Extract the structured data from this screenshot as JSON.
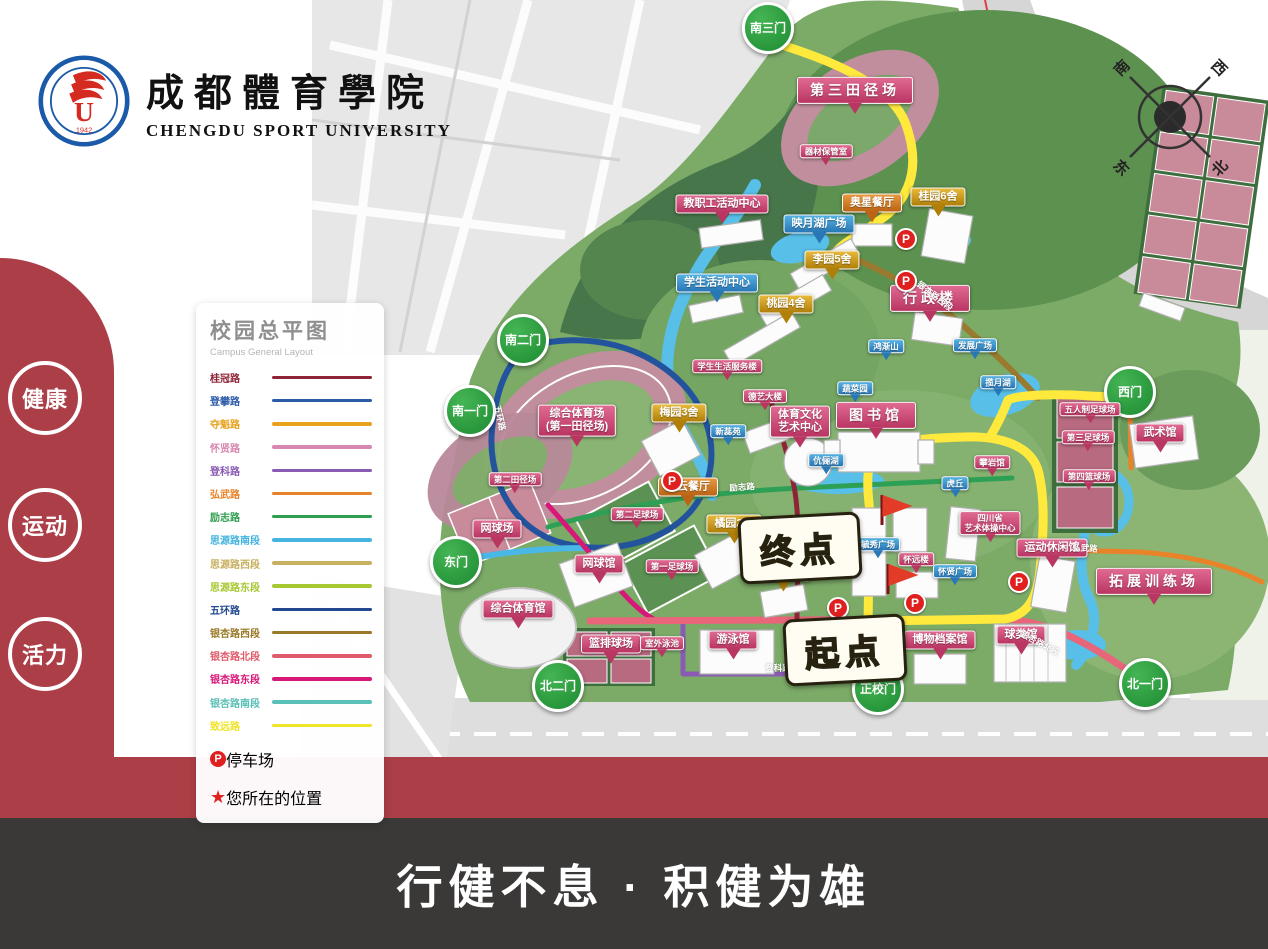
{
  "header": {
    "title_zh": "成都體育學院",
    "title_en": "CHENGDU SPORT UNIVERSITY",
    "logo_year": "1942",
    "logo_letter": "U"
  },
  "side_badges": [
    {
      "label": "健康"
    },
    {
      "label": "运动"
    },
    {
      "label": "活力"
    }
  ],
  "footer": {
    "slogan": "行健不息 · 积健为雄"
  },
  "compass": {
    "south": "南",
    "west": "西",
    "east": "东",
    "north": "北"
  },
  "legend": {
    "title": "校园总平图",
    "subtitle": "Campus General Layout",
    "roads": [
      {
        "name": "桂冠路",
        "color": "#8f2438"
      },
      {
        "name": "登攀路",
        "color": "#2b5ba8"
      },
      {
        "name": "夺魁路",
        "color": "#e8a21e"
      },
      {
        "name": "怀贤路",
        "color": "#d888b0"
      },
      {
        "name": "登科路",
        "color": "#8a5bb5"
      },
      {
        "name": "弘武路",
        "color": "#e8832a"
      },
      {
        "name": "励志路",
        "color": "#2e9e50"
      },
      {
        "name": "思源路南段",
        "color": "#45b4e0"
      },
      {
        "name": "思源路西段",
        "color": "#c8b060"
      },
      {
        "name": "思源路东段",
        "color": "#a8c832"
      },
      {
        "name": "五环路",
        "color": "#22488f"
      },
      {
        "name": "银杏路西段",
        "color": "#9a7a28"
      },
      {
        "name": "银杏路北段",
        "color": "#e05a6a"
      },
      {
        "name": "银杏路东段",
        "color": "#d81878"
      },
      {
        "name": "银杏路南段",
        "color": "#5bc0b8"
      },
      {
        "name": "致远路",
        "color": "#f0e428"
      }
    ],
    "symbols": [
      {
        "icon": "parking-icon",
        "label": "停车场"
      },
      {
        "icon": "star-icon",
        "label": "您所在的位置"
      }
    ]
  },
  "map": {
    "gates": [
      {
        "text": "南三门",
        "x": 768,
        "y": 28
      },
      {
        "text": "南二门",
        "x": 523,
        "y": 340
      },
      {
        "text": "南一门",
        "x": 470,
        "y": 411
      },
      {
        "text": "西门",
        "x": 1130,
        "y": 392
      },
      {
        "text": "东门",
        "x": 456,
        "y": 562
      },
      {
        "text": "北二门",
        "x": 558,
        "y": 686
      },
      {
        "text": "正校门",
        "x": 878,
        "y": 689
      },
      {
        "text": "北一门",
        "x": 1145,
        "y": 684
      }
    ],
    "labels": [
      {
        "type": "building",
        "text": "第三田径场",
        "x": 855,
        "y": 99,
        "big": true
      },
      {
        "type": "building",
        "text": "器材保管室",
        "x": 826,
        "y": 157,
        "small": true
      },
      {
        "type": "building",
        "text": "教职工活动中心",
        "x": 722,
        "y": 212
      },
      {
        "type": "site",
        "text": "映月湖广场",
        "x": 819,
        "y": 232
      },
      {
        "type": "rest",
        "text": "奥星餐厅",
        "x": 872,
        "y": 211
      },
      {
        "type": "dorm",
        "text": "桂园6舍",
        "x": 938,
        "y": 205
      },
      {
        "type": "dorm",
        "text": "李园5舍",
        "x": 832,
        "y": 268
      },
      {
        "type": "site",
        "text": "学生活动中心",
        "x": 717,
        "y": 291
      },
      {
        "type": "dorm",
        "text": "桃园4舍",
        "x": 786,
        "y": 312
      },
      {
        "type": "building",
        "text": "行政楼",
        "x": 930,
        "y": 307,
        "big": true
      },
      {
        "type": "site",
        "text": "鸿渐山",
        "x": 886,
        "y": 352,
        "small": true
      },
      {
        "type": "site",
        "text": "发展广场",
        "x": 975,
        "y": 351,
        "small": true
      },
      {
        "type": "site",
        "text": "揽月湖",
        "x": 998,
        "y": 388,
        "small": true
      },
      {
        "type": "building",
        "text": "学生生活服务楼",
        "x": 727,
        "y": 372,
        "small": true
      },
      {
        "type": "building",
        "text": "德艺大楼",
        "x": 765,
        "y": 402,
        "small": true
      },
      {
        "type": "site",
        "text": "蔬菜园",
        "x": 855,
        "y": 394,
        "small": true
      },
      {
        "type": "dorm",
        "text": "梅园3舍",
        "x": 679,
        "y": 421
      },
      {
        "type": "site",
        "text": "新蕊苑",
        "x": 728,
        "y": 437,
        "small": true
      },
      {
        "type": "building",
        "text": "体育文化",
        "text2": "艺术中心",
        "x": 800,
        "y": 431
      },
      {
        "type": "building",
        "text": "图书馆",
        "x": 876,
        "y": 424,
        "big": true
      },
      {
        "type": "site",
        "text": "伉俪湖",
        "x": 826,
        "y": 466,
        "small": true
      },
      {
        "type": "building",
        "text": "攀岩馆",
        "x": 992,
        "y": 468,
        "small": true
      },
      {
        "type": "site",
        "text": "虎丘",
        "x": 955,
        "y": 489,
        "small": true
      },
      {
        "type": "building",
        "text": "武术馆",
        "x": 1160,
        "y": 441
      },
      {
        "type": "building",
        "text": "五人制足球场",
        "x": 1090,
        "y": 415,
        "small": true
      },
      {
        "type": "building",
        "text": "第三足球场",
        "x": 1088,
        "y": 443,
        "small": true
      },
      {
        "type": "building",
        "text": "第四篮球场",
        "x": 1089,
        "y": 482,
        "small": true
      },
      {
        "type": "building",
        "text": "综合体育场",
        "text2": "(第一田径场)",
        "x": 577,
        "y": 430
      },
      {
        "type": "building",
        "text": "第二田径场",
        "x": 515,
        "y": 485,
        "small": true
      },
      {
        "type": "rest",
        "text": "冠云餐厅",
        "x": 688,
        "y": 495
      },
      {
        "type": "building",
        "text": "第二足球场",
        "x": 637,
        "y": 520,
        "small": true
      },
      {
        "type": "building",
        "text": "网球场",
        "x": 497,
        "y": 537
      },
      {
        "type": "building",
        "text": "第一足球场",
        "x": 672,
        "y": 572,
        "small": true
      },
      {
        "type": "building",
        "text": "网球馆",
        "x": 599,
        "y": 572
      },
      {
        "type": "dorm",
        "text": "橘园2舍",
        "x": 734,
        "y": 532
      },
      {
        "type": "dorm",
        "text": "香园1舍",
        "x": 783,
        "y": 580
      },
      {
        "type": "site",
        "text": "毓秀广场",
        "x": 878,
        "y": 550,
        "small": true
      },
      {
        "type": "building",
        "text": "怀远楼",
        "x": 916,
        "y": 565,
        "small": true
      },
      {
        "type": "site",
        "text": "怀贤广场",
        "x": 955,
        "y": 577,
        "small": true
      },
      {
        "type": "building",
        "text": "四川省",
        "text2": "艺术体操中心",
        "x": 990,
        "y": 530,
        "small": true
      },
      {
        "type": "building",
        "text": "运动休闲馆",
        "x": 1052,
        "y": 556
      },
      {
        "type": "building",
        "text": "拓展训练场",
        "x": 1154,
        "y": 590,
        "big": true
      },
      {
        "type": "building",
        "text": "综合体育馆",
        "x": 518,
        "y": 617
      },
      {
        "type": "building",
        "text": "篮排球场",
        "x": 611,
        "y": 652
      },
      {
        "type": "building",
        "text": "室外泳池",
        "x": 662,
        "y": 649,
        "small": true
      },
      {
        "type": "building",
        "text": "游泳馆",
        "x": 733,
        "y": 648
      },
      {
        "type": "building",
        "text": "博物档案馆",
        "x": 940,
        "y": 648
      },
      {
        "type": "building",
        "text": "球类馆",
        "x": 1021,
        "y": 643
      }
    ],
    "route_points": [
      {
        "text": "终点",
        "x": 800,
        "y": 548
      },
      {
        "text": "起点",
        "x": 845,
        "y": 650
      }
    ],
    "parkings": [
      {
        "x": 906,
        "y": 239
      },
      {
        "x": 906,
        "y": 281
      },
      {
        "x": 672,
        "y": 481
      },
      {
        "x": 838,
        "y": 608
      },
      {
        "x": 915,
        "y": 603
      },
      {
        "x": 1019,
        "y": 582
      }
    ],
    "flags": [
      {
        "x": 882,
        "y": 525
      },
      {
        "x": 888,
        "y": 594
      }
    ],
    "road_names": [
      {
        "text": "五环路",
        "x": 500,
        "y": 418,
        "angle": 78
      },
      {
        "text": "励志路",
        "x": 742,
        "y": 487,
        "angle": -4
      },
      {
        "text": "登科路",
        "x": 778,
        "y": 668,
        "angle": 0
      },
      {
        "text": "银杏路北段",
        "x": 1040,
        "y": 643,
        "angle": 28
      },
      {
        "text": "弘武路",
        "x": 1085,
        "y": 548,
        "angle": 4
      },
      {
        "text": "银杏路西段",
        "x": 935,
        "y": 296,
        "angle": 38
      }
    ]
  }
}
